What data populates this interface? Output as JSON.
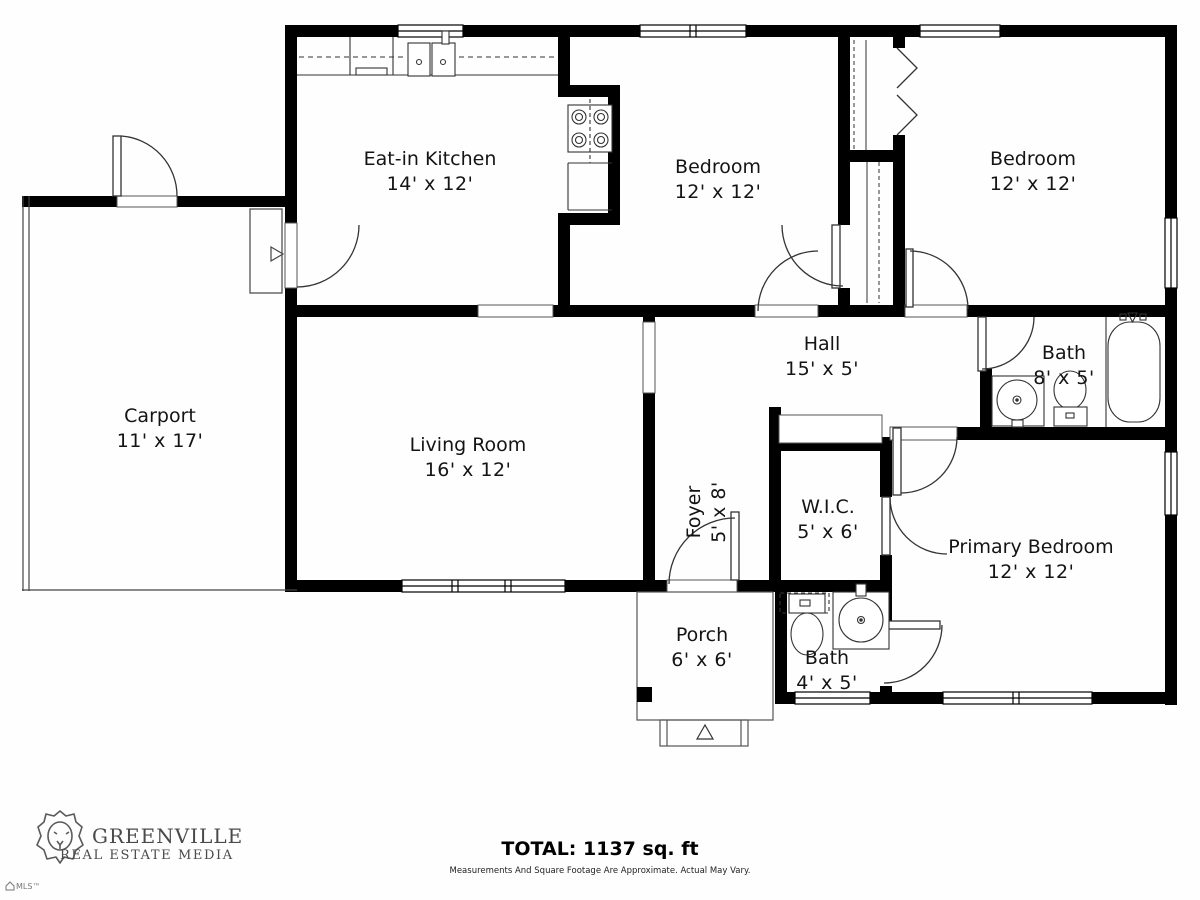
{
  "plan": {
    "rooms": [
      {
        "name": "Eat-in Kitchen",
        "dims": "14' x 12'"
      },
      {
        "name": "Bedroom",
        "dims": "12' x 12'"
      },
      {
        "name": "Bedroom",
        "dims": "12' x 12'"
      },
      {
        "name": "Carport",
        "dims": "11' x 17'"
      },
      {
        "name": "Living Room",
        "dims": "16' x 12'"
      },
      {
        "name": "Hall",
        "dims": "15' x 5'"
      },
      {
        "name": "Bath",
        "dims": "8' x 5'"
      },
      {
        "name": "Foyer",
        "dims": "5' x 8'"
      },
      {
        "name": "W.I.C.",
        "dims": "5' x 6'"
      },
      {
        "name": "Primary Bedroom",
        "dims": "12' x 12'"
      },
      {
        "name": "Porch",
        "dims": "6' x 6'"
      },
      {
        "name": "Bath",
        "dims": "4' x 5'"
      }
    ]
  },
  "footer": {
    "brand_line1": "GREENVILLE",
    "brand_line2": "REAL ESTATE MEDIA",
    "total": "TOTAL: 1137 sq. ft",
    "disclaimer": "Measurements And Square Footage Are Approximate. Actual May Vary.",
    "watermark": "MLS™"
  },
  "colors": {
    "wall": "#000000",
    "line": "#3a3a3a",
    "text": "#141414",
    "brand": "#4a4a4a"
  }
}
